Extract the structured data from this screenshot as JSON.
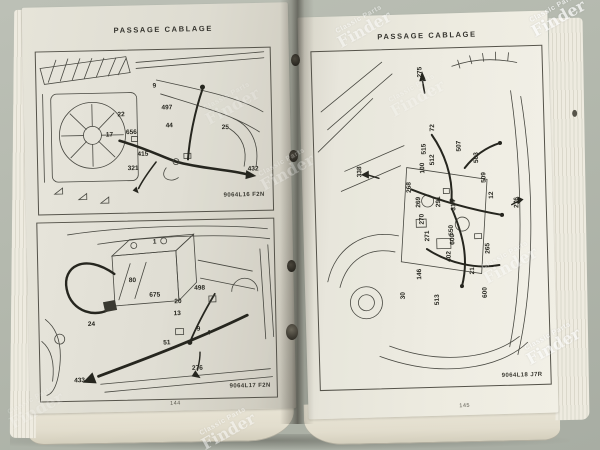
{
  "photo": {
    "watermark": {
      "line1": "Classic Parts",
      "line2": "Finder"
    },
    "background_color": "#b3b8ad",
    "paper_color": "#e8e6db",
    "ink_color": "#45443c"
  },
  "left_page": {
    "header": "PASSAGE CABLAGE",
    "page_number": "144",
    "top_diagram": {
      "caption": "9064L16 F2N",
      "labels": [
        {
          "t": "9",
          "x": 118,
          "y": 36
        },
        {
          "t": "497",
          "x": 130,
          "y": 58
        },
        {
          "t": "22",
          "x": 84,
          "y": 64
        },
        {
          "t": "17",
          "x": 72,
          "y": 84
        },
        {
          "t": "656",
          "x": 94,
          "y": 82
        },
        {
          "t": "44",
          "x": 132,
          "y": 76
        },
        {
          "t": "415",
          "x": 105,
          "y": 104
        },
        {
          "t": "321",
          "x": 95,
          "y": 118
        },
        {
          "t": "25",
          "x": 188,
          "y": 79
        },
        {
          "t": "432",
          "x": 215,
          "y": 121
        }
      ]
    },
    "bottom_diagram": {
      "caption": "9064L17 F2N",
      "labels": [
        {
          "t": "1",
          "x": 117,
          "y": 21
        },
        {
          "t": "80",
          "x": 94,
          "y": 59
        },
        {
          "t": "675",
          "x": 116,
          "y": 74
        },
        {
          "t": "498",
          "x": 161,
          "y": 68
        },
        {
          "t": "20",
          "x": 139,
          "y": 81
        },
        {
          "t": "13",
          "x": 138,
          "y": 93
        },
        {
          "t": "9",
          "x": 159,
          "y": 109
        },
        {
          "t": "4",
          "x": 169,
          "y": 113
        },
        {
          "t": "51",
          "x": 127,
          "y": 122
        },
        {
          "t": "24",
          "x": 52,
          "y": 102
        },
        {
          "t": "433",
          "x": 39,
          "y": 158
        },
        {
          "t": "276",
          "x": 157,
          "y": 148
        }
      ]
    }
  },
  "right_page": {
    "header": "PASSAGE CABLAGE",
    "page_number": "145",
    "diagram": {
      "caption": "9064L18 J7R",
      "labels": [
        {
          "t": "275",
          "x": 108,
          "y": 23,
          "rot": -90
        },
        {
          "t": "72",
          "x": 119,
          "y": 79,
          "rot": -90
        },
        {
          "t": "515",
          "x": 110,
          "y": 100,
          "rot": -90
        },
        {
          "t": "512",
          "x": 118,
          "y": 111,
          "rot": -90
        },
        {
          "t": "507",
          "x": 145,
          "y": 98,
          "rot": -90
        },
        {
          "t": "503",
          "x": 162,
          "y": 110,
          "rot": -90
        },
        {
          "t": "509",
          "x": 169,
          "y": 130,
          "rot": -90
        },
        {
          "t": "100",
          "x": 108,
          "y": 119,
          "rot": -90
        },
        {
          "t": "338",
          "x": 45,
          "y": 121,
          "rot": -90
        },
        {
          "t": "268",
          "x": 94,
          "y": 138,
          "rot": -90
        },
        {
          "t": "269",
          "x": 103,
          "y": 153,
          "rot": -90
        },
        {
          "t": "270",
          "x": 106,
          "y": 170,
          "rot": -90
        },
        {
          "t": "271",
          "x": 111,
          "y": 187,
          "rot": -90
        },
        {
          "t": "291",
          "x": 123,
          "y": 153,
          "rot": -90
        },
        {
          "t": "314",
          "x": 138,
          "y": 157,
          "rot": -90
        },
        {
          "t": "12",
          "x": 176,
          "y": 148,
          "rot": -90
        },
        {
          "t": "276",
          "x": 201,
          "y": 156,
          "rot": -90
        },
        {
          "t": "550",
          "x": 135,
          "y": 182,
          "rot": -90
        },
        {
          "t": "600",
          "x": 136,
          "y": 191,
          "rot": -90
        },
        {
          "t": "402",
          "x": 132,
          "y": 208,
          "rot": -90
        },
        {
          "t": "265",
          "x": 171,
          "y": 201,
          "rot": -90
        },
        {
          "t": "21",
          "x": 155,
          "y": 223,
          "rot": -90
        },
        {
          "t": "146",
          "x": 102,
          "y": 225,
          "rot": -90
        },
        {
          "t": "513",
          "x": 119,
          "y": 251,
          "rot": -90
        },
        {
          "t": "600",
          "x": 167,
          "y": 245,
          "rot": -90
        },
        {
          "t": "30",
          "x": 85,
          "y": 246,
          "rot": -90
        }
      ]
    }
  },
  "watermarks": [
    {
      "x": 557,
      "y": 16,
      "rot": -29,
      "opacity": 0.8
    },
    {
      "x": 363,
      "y": 27,
      "rot": -29,
      "opacity": 0.55
    },
    {
      "x": 231,
      "y": 104,
      "rot": -29,
      "opacity": 0.22
    },
    {
      "x": 416,
      "y": 96,
      "rot": -29,
      "opacity": 0.28
    },
    {
      "x": 286,
      "y": 170,
      "rot": -29,
      "opacity": 0.3
    },
    {
      "x": 509,
      "y": 263,
      "rot": -29,
      "opacity": 0.45
    },
    {
      "x": 552,
      "y": 344,
      "rot": -29,
      "opacity": 0.7
    },
    {
      "x": 227,
      "y": 429,
      "rot": -29,
      "opacity": 0.55
    },
    {
      "x": 35,
      "y": 408,
      "rot": -29,
      "opacity": 0.2
    }
  ]
}
